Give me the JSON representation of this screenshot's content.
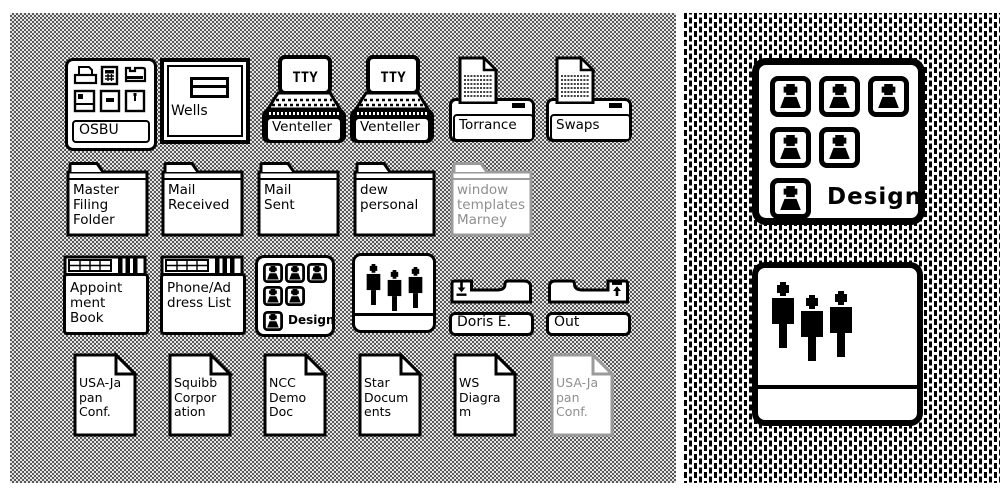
{
  "colors": {
    "icon_outline": "#000000",
    "icon_fill": "#ffffff",
    "ghost_outline": "#9b9b9b",
    "ghost_text": "#8f8f8f",
    "desktop_dither_dark": "#585858",
    "desktop_dither_light": "#e4e4e4",
    "magnified_dash": "#000000",
    "magnified_bg": "#ffffff"
  },
  "desktop": {
    "tty_text": "TTY",
    "row1": [
      {
        "id": "osbu",
        "type": "file-drawer",
        "label": "OSBU"
      },
      {
        "id": "wells",
        "type": "drawer",
        "label": "Wells"
      },
      {
        "id": "venteller-1",
        "type": "terminal",
        "label": "Venteller"
      },
      {
        "id": "venteller-2",
        "type": "terminal",
        "label": "Venteller"
      },
      {
        "id": "torrance",
        "type": "printer",
        "label": "Torrance"
      },
      {
        "id": "swaps",
        "type": "printer",
        "label": "Swaps"
      }
    ],
    "row2": [
      {
        "id": "master-filing-folder",
        "type": "folder",
        "label": "Master\nFiling\nFolder"
      },
      {
        "id": "mail-received",
        "type": "folder",
        "label": "Mail\nReceived"
      },
      {
        "id": "mail-sent",
        "type": "folder",
        "label": "Mail\nSent"
      },
      {
        "id": "dew-personal",
        "type": "folder",
        "label": "dew\npersonal"
      },
      {
        "id": "window-templates-marney",
        "type": "folder",
        "ghost": true,
        "label": "window\ntemplates\nMarney"
      }
    ],
    "row3": [
      {
        "id": "appointment-book",
        "type": "ledger",
        "label": "Appoint\nment\nBook"
      },
      {
        "id": "phone-address-list",
        "type": "ledger",
        "label": "Phone/Ad\ndress List"
      },
      {
        "id": "design-group-small",
        "type": "group",
        "label": "Design"
      },
      {
        "id": "people-small",
        "type": "people",
        "label": ""
      },
      {
        "id": "doris-e",
        "type": "in-basket",
        "label": "Doris E."
      },
      {
        "id": "out",
        "type": "out-basket",
        "label": "Out"
      }
    ],
    "row4": [
      {
        "id": "usa-japan-conf",
        "type": "document",
        "label": "USA-Ja\npan\nConf."
      },
      {
        "id": "squibb-corporation",
        "type": "document",
        "label": "Squibb\nCorpor\nation"
      },
      {
        "id": "ncc-demo-doc",
        "type": "document",
        "label": "NCC\nDemo\nDoc"
      },
      {
        "id": "star-documents",
        "type": "document",
        "label": "Star\nDocum\nents"
      },
      {
        "id": "ws-diagram",
        "type": "document",
        "label": "WS\nDiagra\nm"
      },
      {
        "id": "usa-japan-conf-ghost",
        "type": "document",
        "ghost": true,
        "label": "USA-Ja\npan\nConf."
      }
    ]
  },
  "magnified": {
    "design": {
      "label": "Design"
    },
    "people": {
      "label": ""
    }
  }
}
